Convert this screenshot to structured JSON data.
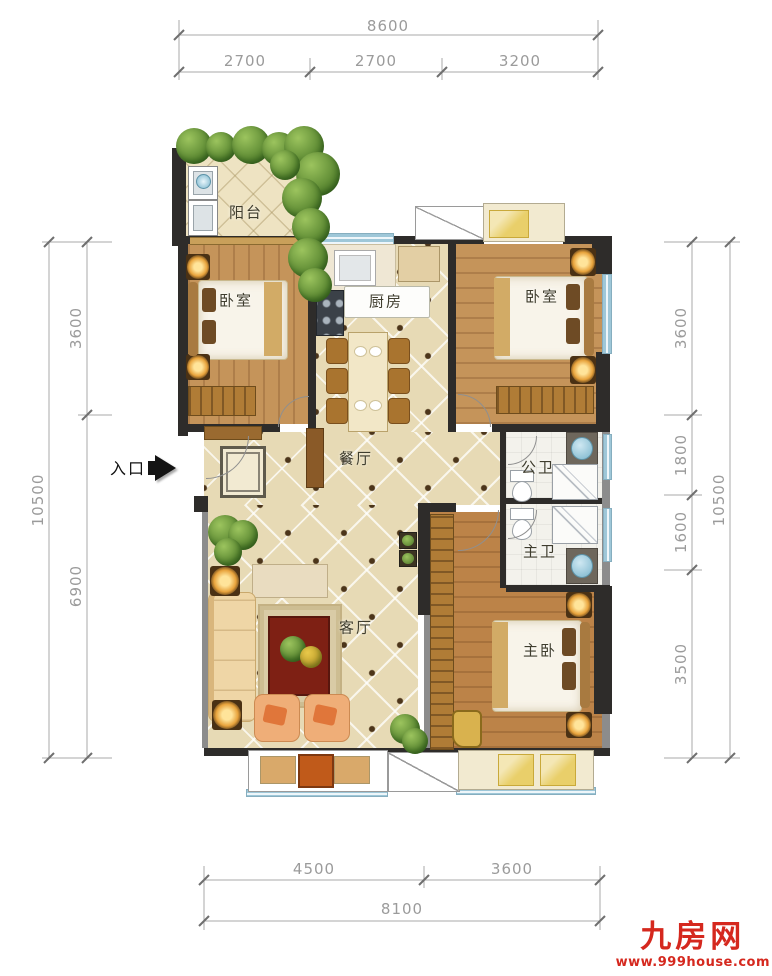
{
  "dimensions": {
    "top": {
      "total": "8600",
      "segments": [
        "2700",
        "2700",
        "3200"
      ]
    },
    "left": {
      "total": "10500",
      "segments": [
        "3600",
        "6900"
      ]
    },
    "right": {
      "total": "10500",
      "segments": [
        "3600",
        "1800",
        "1600",
        "3500"
      ]
    },
    "bottom": {
      "total": "8100",
      "segments": [
        "4500",
        "3600"
      ]
    }
  },
  "rooms": {
    "balcony": "阳台",
    "bedroom_left": "卧室",
    "bedroom_right": "卧室",
    "kitchen": "厨房",
    "dining": "餐厅",
    "living": "客厅",
    "bath_public": "公卫",
    "bath_master": "主卫",
    "master_bedroom": "主卧"
  },
  "entrance": {
    "label": "入口"
  },
  "watermark": {
    "brand": "九房网",
    "site": "www.999house.com",
    "color": "#d5281e"
  },
  "colors": {
    "wall": "#2e2c2a",
    "wood_floor": "#c5945a",
    "tile_floor": "#e7dab5",
    "window": "#9ec7d8"
  }
}
